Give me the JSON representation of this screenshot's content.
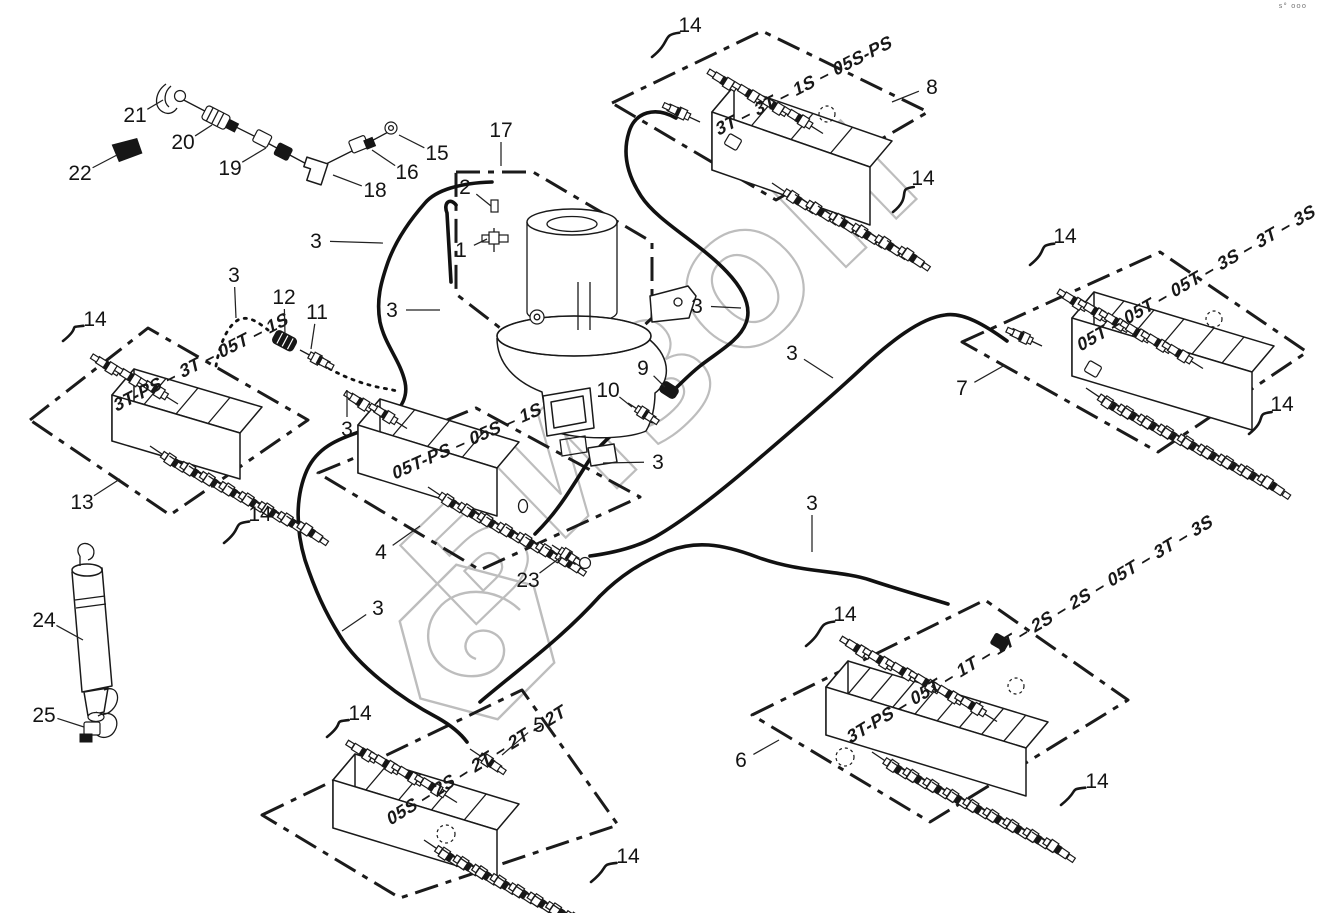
{
  "watermark": {
    "text": "БИЗОН",
    "color": "#bdbdbd"
  },
  "corner_mark": "s° ooo",
  "diagram": {
    "separator": " – ",
    "blocks": [
      {
        "id": "block-8",
        "callout": "8",
        "sections_top_to_bottom": [
          "05S-PS",
          "1S",
          "3T",
          "3T"
        ]
      },
      {
        "id": "block-7",
        "callout": "7",
        "sections_top_to_bottom": [
          "3S",
          "3T",
          "3S",
          "05T",
          "05T",
          "05T"
        ]
      },
      {
        "id": "block-13",
        "callout": "13",
        "sections_top_to_bottom": [
          "1S",
          "05T",
          "3T",
          "3T-PS"
        ]
      },
      {
        "id": "block-4",
        "callout": "4",
        "sections_top_to_bottom": [
          "2T",
          "1S",
          "05S",
          "05T-PS"
        ]
      },
      {
        "id": "block-5",
        "callout": "5",
        "sections_top_to_bottom": [
          "2T",
          "2T",
          "2T",
          "2S",
          "05S"
        ]
      },
      {
        "id": "block-6",
        "callout": "6",
        "sections_top_to_bottom": [
          "3S",
          "3T",
          "05T",
          "2S",
          "2S",
          "1T",
          "1T",
          "05T",
          "3T-PS"
        ]
      }
    ],
    "callouts": [
      {
        "n": "1",
        "x": 461,
        "y": 250,
        "tx": 487,
        "ty": 239,
        "style": "plain"
      },
      {
        "n": "2",
        "x": 465,
        "y": 187,
        "tx": 491,
        "ty": 206,
        "style": "plain"
      },
      {
        "n": "3",
        "x": 234,
        "y": 275,
        "tx": 236,
        "ty": 318,
        "style": "plain"
      },
      {
        "n": "3",
        "x": 316,
        "y": 241,
        "tx": 383,
        "ty": 243,
        "style": "plain"
      },
      {
        "n": "3",
        "x": 392,
        "y": 310,
        "tx": 440,
        "ty": 310,
        "style": "plain"
      },
      {
        "n": "3",
        "x": 347,
        "y": 429,
        "tx": 347,
        "ty": 390,
        "style": "plain"
      },
      {
        "n": "3",
        "x": 658,
        "y": 462,
        "tx": 603,
        "ty": 463,
        "style": "plain"
      },
      {
        "n": "3",
        "x": 697,
        "y": 306,
        "tx": 741,
        "ty": 308,
        "style": "plain"
      },
      {
        "n": "3",
        "x": 792,
        "y": 353,
        "tx": 833,
        "ty": 378,
        "style": "plain"
      },
      {
        "n": "3",
        "x": 812,
        "y": 503,
        "tx": 812,
        "ty": 552,
        "style": "plain"
      },
      {
        "n": "3",
        "x": 378,
        "y": 608,
        "tx": 342,
        "ty": 631,
        "style": "plain"
      },
      {
        "n": "4",
        "x": 381,
        "y": 552,
        "tx": 420,
        "ty": 526,
        "style": "plain"
      },
      {
        "n": "5",
        "x": 539,
        "y": 725,
        "tx": 502,
        "ty": 755,
        "style": "plain"
      },
      {
        "n": "6",
        "x": 741,
        "y": 760,
        "tx": 779,
        "ty": 740,
        "style": "plain"
      },
      {
        "n": "7",
        "x": 962,
        "y": 388,
        "tx": 1005,
        "ty": 365,
        "style": "plain"
      },
      {
        "n": "8",
        "x": 932,
        "y": 87,
        "tx": 892,
        "ty": 102,
        "style": "plain"
      },
      {
        "n": "9",
        "x": 643,
        "y": 368,
        "tx": 665,
        "ty": 387,
        "style": "plain"
      },
      {
        "n": "10",
        "x": 608,
        "y": 390,
        "tx": 632,
        "ty": 407,
        "style": "plain"
      },
      {
        "n": "11",
        "x": 317,
        "y": 312,
        "tx": 311,
        "ty": 349,
        "style": "plain"
      },
      {
        "n": "12",
        "x": 284,
        "y": 297,
        "tx": 285,
        "ty": 334,
        "style": "plain"
      },
      {
        "n": "13",
        "x": 82,
        "y": 502,
        "tx": 120,
        "ty": 479,
        "style": "plain"
      },
      {
        "n": "14",
        "x": 690,
        "y": 25,
        "tx": 652,
        "ty": 57,
        "style": "wavy"
      },
      {
        "n": "14",
        "x": 923,
        "y": 178,
        "tx": 893,
        "ty": 212,
        "style": "wavy"
      },
      {
        "n": "14",
        "x": 1065,
        "y": 236,
        "tx": 1030,
        "ty": 265,
        "style": "wavy"
      },
      {
        "n": "14",
        "x": 1282,
        "y": 404,
        "tx": 1249,
        "ty": 434,
        "style": "wavy"
      },
      {
        "n": "14",
        "x": 95,
        "y": 319,
        "tx": 63,
        "ty": 341,
        "style": "wavy"
      },
      {
        "n": "14",
        "x": 260,
        "y": 514,
        "tx": 224,
        "ty": 543,
        "style": "wavy"
      },
      {
        "n": "14",
        "x": 360,
        "y": 713,
        "tx": 327,
        "ty": 737,
        "style": "wavy"
      },
      {
        "n": "14",
        "x": 628,
        "y": 856,
        "tx": 591,
        "ty": 882,
        "style": "wavy"
      },
      {
        "n": "14",
        "x": 845,
        "y": 614,
        "tx": 806,
        "ty": 646,
        "style": "wavy"
      },
      {
        "n": "14",
        "x": 1097,
        "y": 781,
        "tx": 1061,
        "ty": 805,
        "style": "wavy"
      },
      {
        "n": "15",
        "x": 437,
        "y": 153,
        "tx": 399,
        "ty": 135,
        "style": "plain"
      },
      {
        "n": "16",
        "x": 407,
        "y": 172,
        "tx": 372,
        "ty": 150,
        "style": "plain"
      },
      {
        "n": "17",
        "x": 501,
        "y": 130,
        "tx": 501,
        "ty": 166,
        "style": "plain"
      },
      {
        "n": "18",
        "x": 375,
        "y": 190,
        "tx": 333,
        "ty": 175,
        "style": "plain"
      },
      {
        "n": "19",
        "x": 230,
        "y": 168,
        "tx": 266,
        "ty": 148,
        "style": "plain"
      },
      {
        "n": "20",
        "x": 183,
        "y": 142,
        "tx": 212,
        "ty": 125,
        "style": "plain"
      },
      {
        "n": "21",
        "x": 135,
        "y": 115,
        "tx": 163,
        "ty": 100,
        "style": "plain"
      },
      {
        "n": "22",
        "x": 80,
        "y": 173,
        "tx": 117,
        "ty": 155,
        "style": "plain"
      },
      {
        "n": "23",
        "x": 528,
        "y": 580,
        "tx": 561,
        "ty": 557,
        "style": "plain"
      },
      {
        "n": "24",
        "x": 44,
        "y": 620,
        "tx": 83,
        "ty": 640,
        "style": "plain"
      },
      {
        "n": "25",
        "x": 44,
        "y": 715,
        "tx": 84,
        "ty": 727,
        "style": "plain"
      }
    ]
  }
}
